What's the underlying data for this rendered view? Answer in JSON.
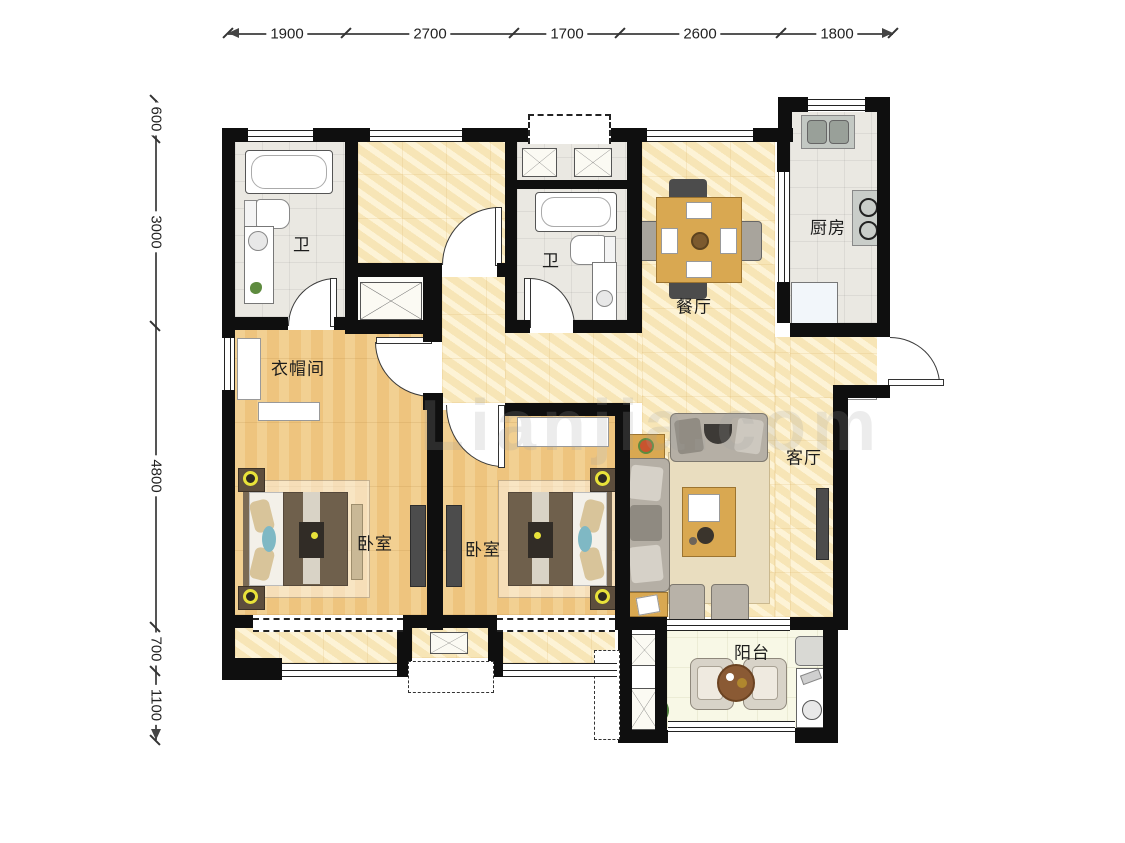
{
  "watermark": "Lianjia.com",
  "dims": {
    "top": [
      "1900",
      "2700",
      "1700",
      "2600",
      "1800"
    ],
    "left": [
      "600",
      "3000",
      "4800",
      "700",
      "1100"
    ]
  },
  "rooms": {
    "bath1": {
      "label": "卫"
    },
    "bath2": {
      "label": "卫"
    },
    "kitchen": {
      "label": "厨房"
    },
    "dining": {
      "label": "餐厅"
    },
    "cloakroom": {
      "label": "衣帽间"
    },
    "bedroom1": {
      "label": "卧室"
    },
    "bedroom2": {
      "label": "卧室"
    },
    "living": {
      "label": "客厅"
    },
    "balcony": {
      "label": "阳台"
    }
  },
  "colors": {
    "wall": "#0f0f0f",
    "marble_floor": "#f7e7bd",
    "wood_floor": "#eec47e",
    "tile_floor": "#eae8e2",
    "balcony_floor": "#f8f8e6",
    "furniture_wood": "#d9a851",
    "sofa_gray": "#b5afa5",
    "lamp_yellow": "#e8e23a"
  }
}
